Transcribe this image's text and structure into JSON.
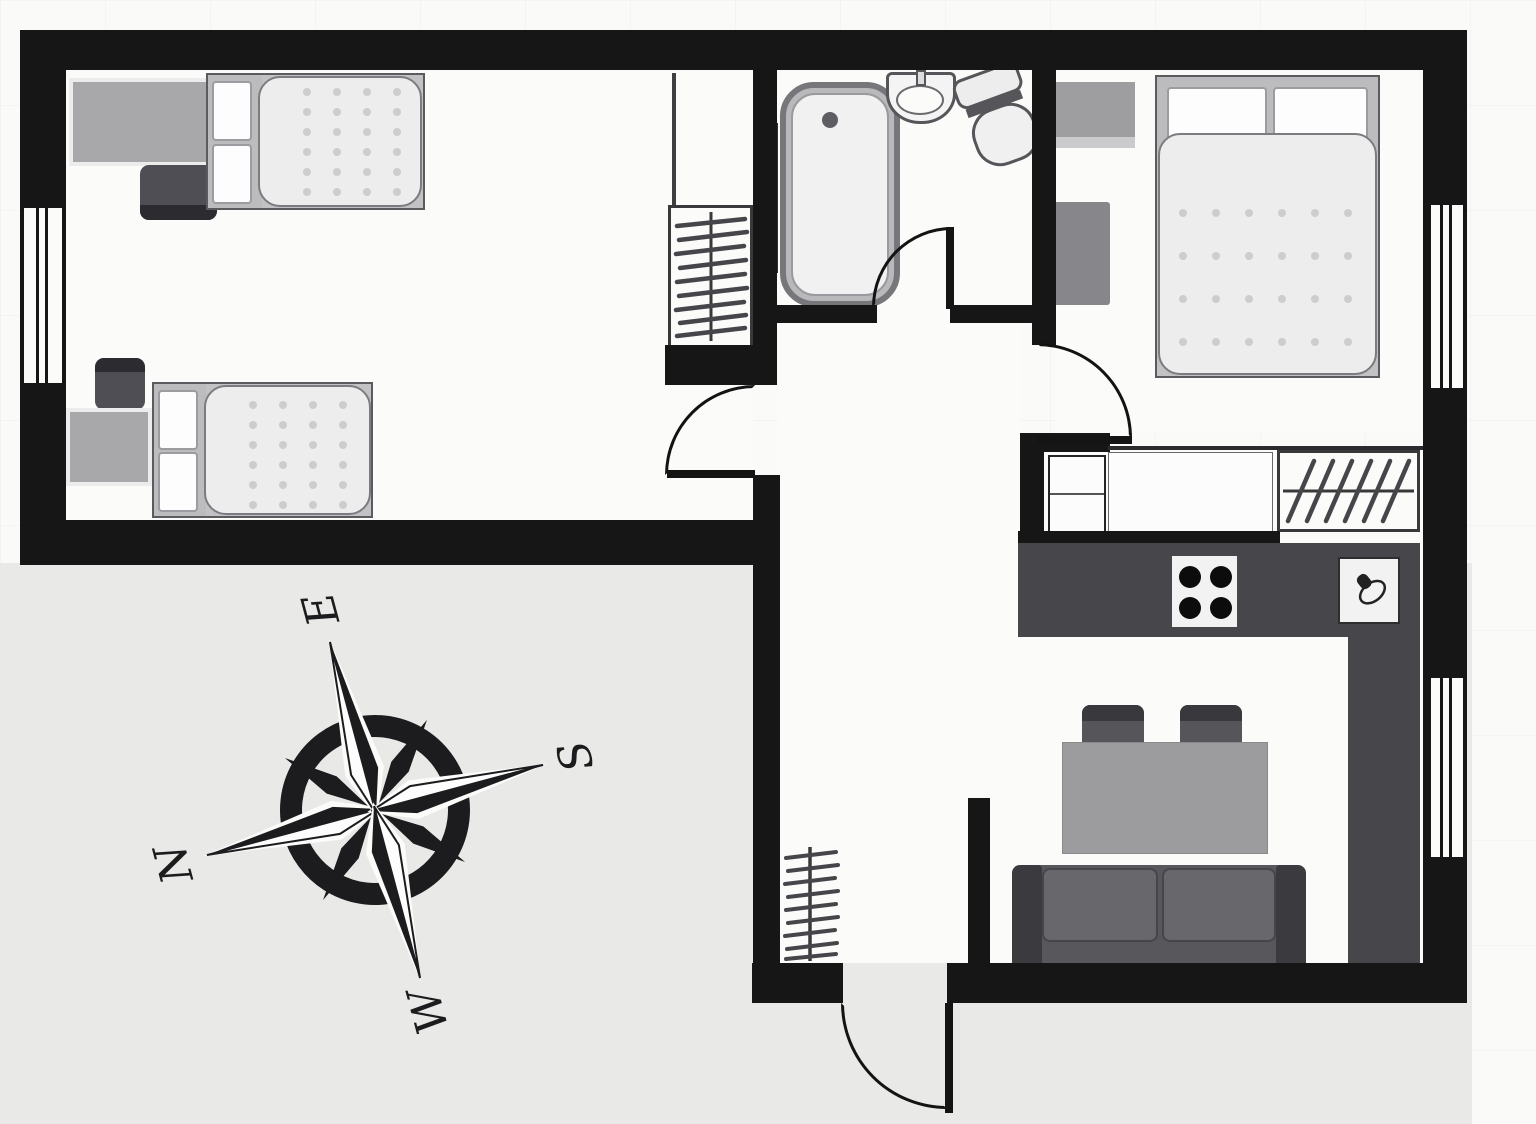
{
  "title": "Two-bedroom apartment floor plan with compass rose",
  "compass": {
    "n": "N",
    "e": "E",
    "s": "S",
    "w": "W",
    "rotation_deg": -105
  },
  "palette": {
    "wall": "#161616",
    "floor": "#fbfbfa",
    "outside": "#e9e9e8",
    "counter": "#47474b",
    "furniture_light_gray": "#a8a8aa",
    "furniture_dark_gray": "#50505a",
    "mattress": "#ededee",
    "fixture_stroke": "#55555a"
  },
  "rooms": [
    {
      "name": "bedroom-left",
      "furniture": [
        "desk",
        "wall-shelf",
        "office-chair",
        "single-bed",
        "single-bed",
        "desk",
        "office-chair",
        "closet",
        "wardrobe-rack"
      ]
    },
    {
      "name": "bathroom",
      "furniture": [
        "bathtub",
        "washbasin",
        "toilet",
        "towel-radiator"
      ]
    },
    {
      "name": "hallway",
      "furniture": [
        "coat-rack"
      ]
    },
    {
      "name": "bedroom-right",
      "furniture": [
        "dresser",
        "double-bed",
        "side-cabinet"
      ]
    },
    {
      "name": "kitchen-living-room",
      "furniture": [
        "cabinet",
        "worktop",
        "wardrobe-rack",
        "kitchen-counter",
        "stove",
        "kitchen-sink",
        "dining-table",
        "chair",
        "chair",
        "sofa"
      ]
    }
  ],
  "openings": {
    "windows": 3,
    "doors": 4,
    "entry_door": "south"
  }
}
